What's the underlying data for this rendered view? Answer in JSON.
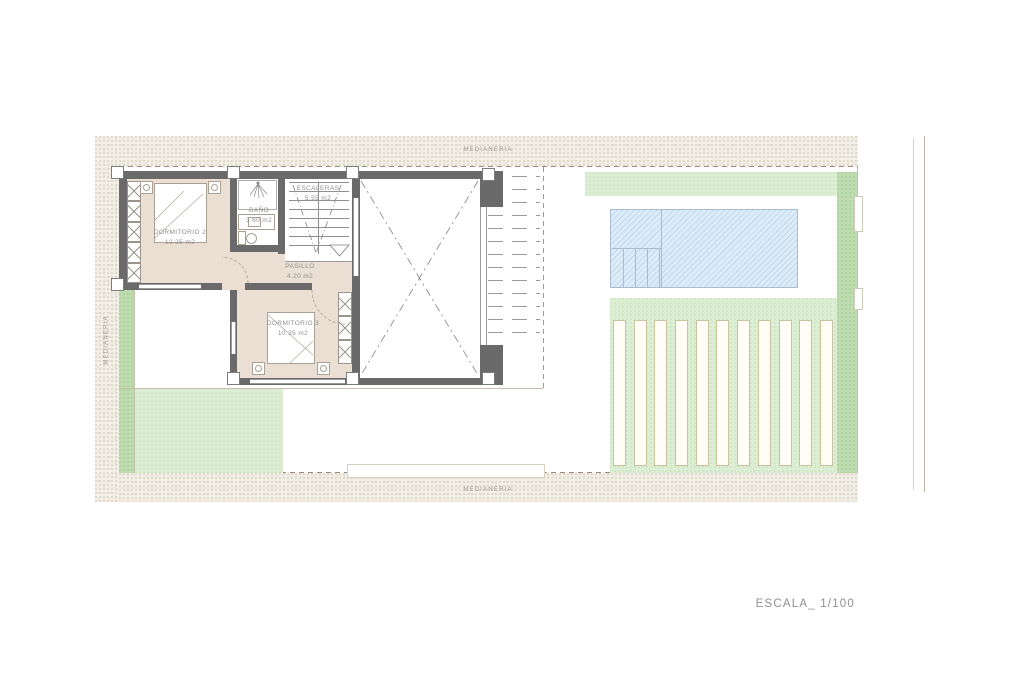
{
  "drawing": {
    "scale_label": "ESCALA_ 1/100",
    "boundaries": {
      "top": "MEDIANERIA",
      "left": "MEDIANERIA",
      "bottom": "MEDIANERIA"
    },
    "rooms": {
      "dormitorio2": {
        "name": "DORMITORIO 2",
        "area": "12.25 m2"
      },
      "bano": {
        "name": "BAÑO",
        "area": "3.60 m2"
      },
      "escaleras": {
        "name": "ESCALERAS",
        "area": "5.55 m2"
      },
      "pasillo": {
        "name": "PASILLO",
        "area": "4.20 m2"
      },
      "dormitorio3": {
        "name": "DORMITORIO 3",
        "area": "10.35 m2"
      }
    },
    "colors": {
      "wall": "#6a6a6a",
      "room_floor": "#eadfd2",
      "garden_light": "#dceed3",
      "garden_dark": "#bedcb0",
      "pool_water": "#dcecf8",
      "party_wall_band": "#f2efe8",
      "label_text": "#8f8f8f"
    }
  }
}
